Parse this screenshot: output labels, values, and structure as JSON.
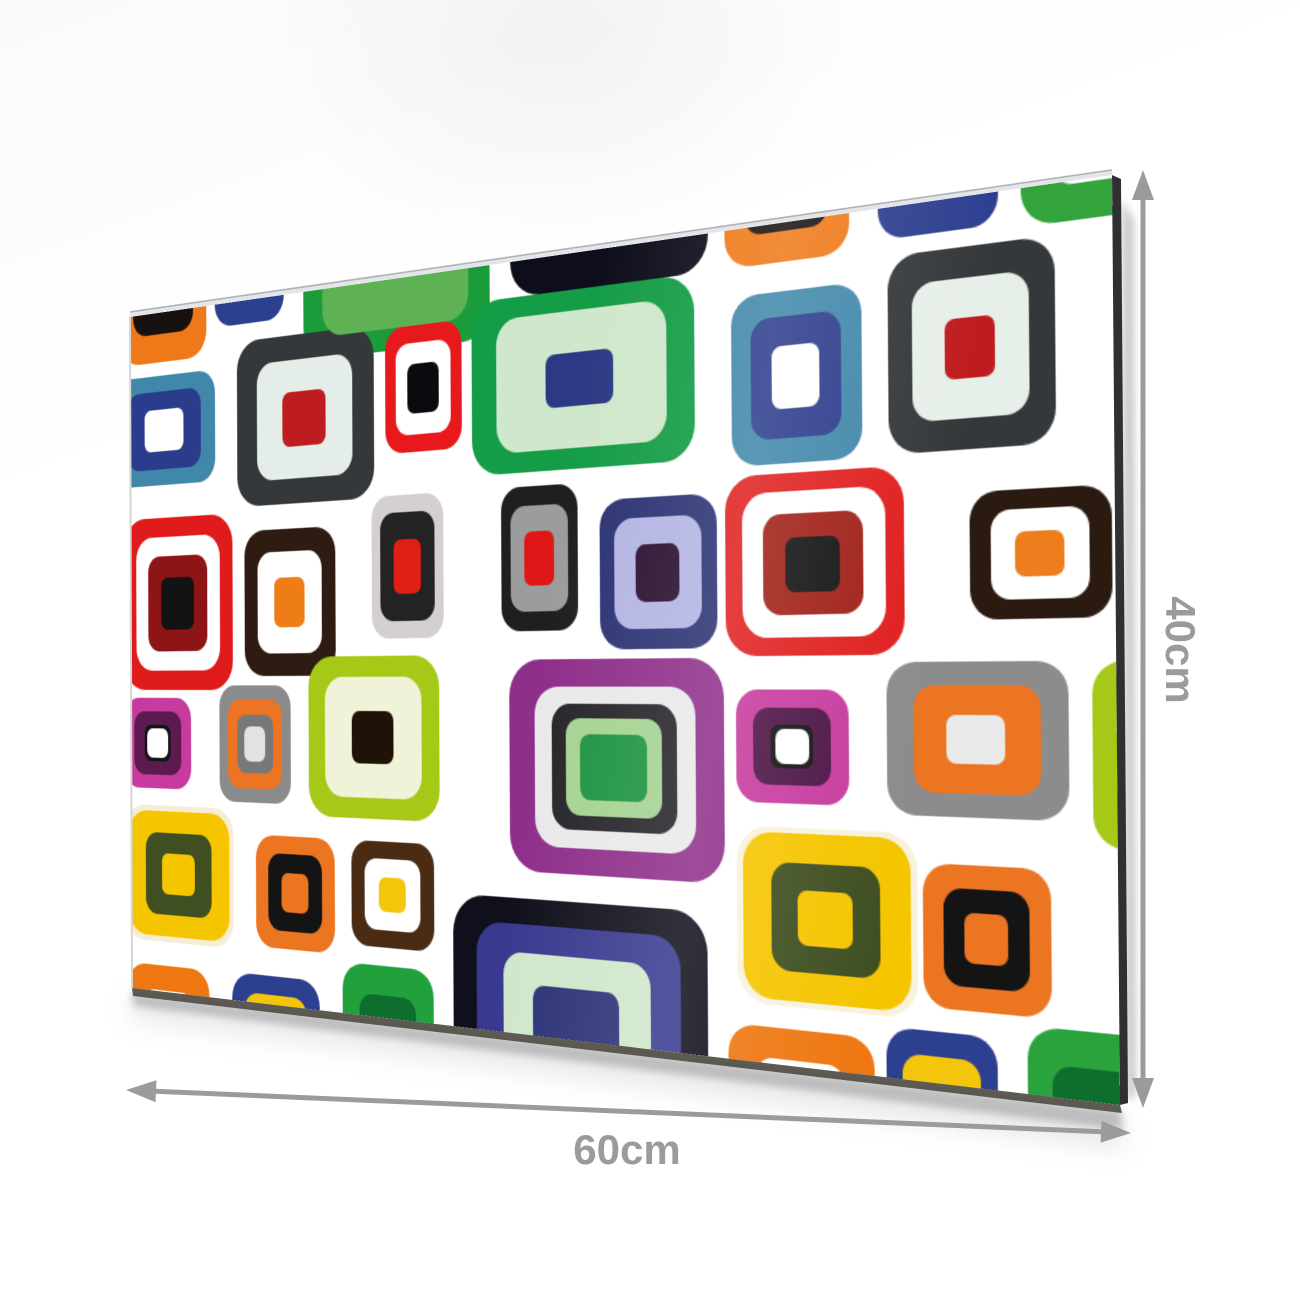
{
  "product": {
    "width_label": "60cm",
    "height_label": "40cm",
    "annotation_color": "#9b9b9b",
    "arrow": {
      "stroke_width": 5,
      "vertical": {
        "x": 1143,
        "y1": 170,
        "y2": 1108
      },
      "horizontal": {
        "x1": 126,
        "y1": 1090,
        "x2": 1131,
        "y2": 1133
      }
    },
    "labels": {
      "height_pos": {
        "x": 1180,
        "y": 650
      },
      "width_pos": {
        "x": 627,
        "y": 1126
      }
    },
    "panel": {
      "flat_width": 900,
      "flat_height": 600,
      "background": "#ffffff",
      "corners": {
        "tl": [
          130,
          317
        ],
        "tr": [
          1112,
          175
        ],
        "bl": [
          132,
          988
        ],
        "br": [
          1120,
          1105
        ]
      },
      "edge_colors": {
        "top_highlight": "#e3e6e9",
        "top_line": "#aeb2b6",
        "right_side": "#303034",
        "bottom_side": "#4e4a42",
        "left_line": "#d5d5d5",
        "shadow": "#8a8a8a",
        "soft_shadow": "#aaaaaa"
      },
      "tiles": [
        {
          "x": -12,
          "y": -120,
          "w": 106,
          "h": 164,
          "r": 26,
          "layers": [
            "#ef7918",
            "#17120f",
            "#ffffff"
          ],
          "scales": [
            1,
            0.7,
            0.42
          ]
        },
        {
          "x": 104,
          "y": -132,
          "w": 80,
          "h": 152,
          "r": 22,
          "layers": [
            "#2d3f8f",
            "#f3c50b",
            "#ffffff"
          ],
          "scales": [
            1,
            0.66,
            0.34
          ]
        },
        {
          "x": 206,
          "y": -104,
          "w": 194,
          "h": 162,
          "r": 30,
          "layers": [
            "#1b9c3b",
            "#5fb253"
          ],
          "scales": [
            1,
            0.78
          ]
        },
        {
          "x": 420,
          "y": -122,
          "w": 178,
          "h": 150,
          "r": 30,
          "layers": [
            "#0d0d1b"
          ],
          "scales": [
            1
          ]
        },
        {
          "x": 612,
          "y": -112,
          "w": 100,
          "h": 140,
          "r": 24,
          "layers": [
            "#ef7918",
            "#17120f",
            "#ffffff"
          ],
          "scales": [
            1,
            0.68,
            0.38
          ]
        },
        {
          "x": 734,
          "y": -116,
          "w": 88,
          "h": 138,
          "r": 22,
          "layers": [
            "#2d3f8f",
            "#f3c50b",
            "#ffffff"
          ],
          "scales": [
            1,
            0.66,
            0.34
          ]
        },
        {
          "x": 838,
          "y": -96,
          "w": 108,
          "h": 122,
          "r": 26,
          "layers": [
            "#33a43c",
            "#ffffff"
          ],
          "scales": [
            1,
            0.6
          ]
        },
        {
          "x": -20,
          "y": 56,
          "w": 124,
          "h": 97,
          "r": 22,
          "layers": [
            "#4187aa",
            "#2c3c8c",
            "#ffffff"
          ],
          "scales": [
            1,
            0.72,
            0.38
          ]
        },
        {
          "x": 130,
          "y": 35,
          "w": 152,
          "h": 142,
          "r": 28,
          "layers": [
            "#35383a",
            "#e4ede7",
            "#bf1c1f"
          ],
          "scales": [
            1,
            0.7,
            0.32
          ]
        },
        {
          "x": 294,
          "y": 40,
          "w": 78,
          "h": 102,
          "r": 20,
          "layers": [
            "#e8191c",
            "#ffffff",
            "#0a0a0f"
          ],
          "scales": [
            1,
            0.72,
            0.4
          ]
        },
        {
          "x": 382,
          "y": 28,
          "w": 204,
          "h": 137,
          "r": 30,
          "layers": [
            "#149c46",
            "#cfe7cb",
            "#2c3a85"
          ],
          "scales": [
            1,
            0.76,
            0.3
          ]
        },
        {
          "x": 617,
          "y": 49,
          "w": 104,
          "h": 123,
          "r": 24,
          "layers": [
            "#4187aa",
            "#2c3c8c",
            "#ffffff"
          ],
          "scales": [
            1,
            0.7,
            0.36
          ]
        },
        {
          "x": 741,
          "y": 34,
          "w": 120,
          "h": 137,
          "r": 26,
          "layers": [
            "#35383a",
            "#e7efe9",
            "#bf1c1f"
          ],
          "scales": [
            1,
            0.7,
            0.3
          ]
        },
        {
          "x": -8,
          "y": 182,
          "w": 132,
          "h": 152,
          "r": 28,
          "layers": [
            "#df1b1b",
            "#ffffff",
            "#8e1515",
            "#131313"
          ],
          "scales": [
            1,
            0.78,
            0.55,
            0.3
          ]
        },
        {
          "x": 138,
          "y": 198,
          "w": 102,
          "h": 124,
          "r": 24,
          "layers": [
            "#2e1c12",
            "#ffffff",
            "#ee7d18"
          ],
          "scales": [
            1,
            0.7,
            0.34
          ]
        },
        {
          "x": 279,
          "y": 176,
          "w": 74,
          "h": 116,
          "r": 20,
          "layers": [
            "#d5cfd3",
            "#232323",
            "#e02017"
          ],
          "scales": [
            1,
            0.76,
            0.38
          ]
        },
        {
          "x": 410,
          "y": 176,
          "w": 72,
          "h": 112,
          "r": 20,
          "layers": [
            "#1f1f1f",
            "#9c9c9c",
            "#e01717"
          ],
          "scales": [
            1,
            0.74,
            0.38
          ]
        },
        {
          "x": 502,
          "y": 190,
          "w": 102,
          "h": 113,
          "r": 24,
          "layers": [
            "#2b3272",
            "#b3b5e3",
            "#2a1030"
          ],
          "scales": [
            1,
            0.74,
            0.38
          ]
        },
        {
          "x": 611,
          "y": 179,
          "w": 141,
          "h": 130,
          "r": 28,
          "layers": [
            "#e01f1f",
            "#ffffff",
            "#a02018",
            "#141414"
          ],
          "scales": [
            1,
            0.8,
            0.56,
            0.3
          ]
        },
        {
          "x": 800,
          "y": 200,
          "w": 98,
          "h": 86,
          "r": 22,
          "layers": [
            "#2a1a10",
            "#ffffff",
            "#ee7d1d"
          ],
          "scales": [
            1,
            0.7,
            0.34
          ]
        },
        {
          "x": -8,
          "y": 341,
          "w": 82,
          "h": 80,
          "r": 20,
          "layers": [
            "#c73b9e",
            "#5c1a51",
            "#131313",
            "#ffffff"
          ],
          "scales": [
            1,
            0.7,
            0.4,
            0.32
          ]
        },
        {
          "x": 108,
          "y": 330,
          "w": 82,
          "h": 100,
          "r": 20,
          "layers": [
            "#8b8b8b",
            "#ec7422",
            "#787878",
            "#e2e2e2"
          ],
          "scales": [
            1,
            0.76,
            0.5,
            0.3
          ]
        },
        {
          "x": 210,
          "y": 306,
          "w": 138,
          "h": 133,
          "r": 28,
          "layers": [
            "#a5c916",
            "#f1f3d9",
            "#1f1207"
          ],
          "scales": [
            1,
            0.74,
            0.32
          ]
        },
        {
          "x": 417,
          "y": 310,
          "w": 192,
          "h": 164,
          "r": 32,
          "layers": [
            "#8e2f8a",
            "#e9e9ea",
            "#26262a",
            "#a6d392",
            "#1d9441"
          ],
          "scales": [
            1,
            0.75,
            0.58,
            0.45,
            0.31
          ]
        },
        {
          "x": 619,
          "y": 333,
          "w": 90,
          "h": 81,
          "r": 20,
          "layers": [
            "#c73b9e",
            "#4d1445",
            "#131313",
            "#ffffff"
          ],
          "scales": [
            1,
            0.68,
            0.38,
            0.3
          ]
        },
        {
          "x": 738,
          "y": 314,
          "w": 130,
          "h": 105,
          "r": 24,
          "layers": [
            "#8c8c8c",
            "#ec7522",
            "#e9e9e9"
          ],
          "scales": [
            1,
            0.7,
            0.32
          ]
        },
        {
          "x": 884,
          "y": 314,
          "w": 100,
          "h": 122,
          "r": 24,
          "layers": [
            "#a5c916",
            "#f1f3d9"
          ],
          "scales": [
            1,
            0.55
          ]
        },
        {
          "x": -8,
          "y": 436,
          "w": 132,
          "h": 120,
          "r": 26,
          "layers": [
            "#f6edd4",
            "#f5c500",
            "#3f4f21",
            "#f5c500"
          ],
          "scales": [
            1,
            0.92,
            0.6,
            0.3
          ]
        },
        {
          "x": 150,
          "y": 457,
          "w": 88,
          "h": 95,
          "r": 22,
          "layers": [
            "#ec7522",
            "#141414",
            "#ec7522"
          ],
          "scales": [
            1,
            0.68,
            0.34
          ]
        },
        {
          "x": 256,
          "y": 457,
          "w": 86,
          "h": 86,
          "r": 20,
          "layers": [
            "#4a2c14",
            "#ffffff",
            "#f3c50b"
          ],
          "scales": [
            1,
            0.68,
            0.32
          ]
        },
        {
          "x": 361,
          "y": 495,
          "w": 233,
          "h": 200,
          "r": 34,
          "layers": [
            "#10101c",
            "#39398f",
            "#cfe7cb",
            "#2c3177"
          ],
          "scales": [
            1,
            0.8,
            0.58,
            0.34
          ]
        },
        {
          "x": 619,
          "y": 431,
          "w": 141,
          "h": 127,
          "r": 28,
          "layers": [
            "#f8f2dc",
            "#f5c500",
            "#3f4f21",
            "#f5c500"
          ],
          "scales": [
            1,
            0.93,
            0.6,
            0.3
          ]
        },
        {
          "x": 764,
          "y": 451,
          "w": 91,
          "h": 98,
          "r": 22,
          "layers": [
            "#ec7522",
            "#141414",
            "#ec7522"
          ],
          "scales": [
            1,
            0.68,
            0.34
          ]
        },
        {
          "x": -5,
          "y": 577,
          "w": 100,
          "h": 110,
          "r": 24,
          "layers": [
            "#ee7711",
            "#ffffff"
          ],
          "scales": [
            1,
            0.6
          ]
        },
        {
          "x": 122,
          "y": 576,
          "w": 99,
          "h": 115,
          "r": 24,
          "layers": [
            "#2d3f8f",
            "#f3c50b",
            "#2d3f8f"
          ],
          "scales": [
            1,
            0.72,
            0.4
          ]
        },
        {
          "x": 246,
          "y": 558,
          "w": 95,
          "h": 125,
          "r": 24,
          "layers": [
            "#22a03c",
            "#0e6e2e"
          ],
          "scales": [
            1,
            0.62
          ]
        },
        {
          "x": 611,
          "y": 574,
          "w": 116,
          "h": 110,
          "r": 24,
          "layers": [
            "#ee7711",
            "#ffffff"
          ],
          "scales": [
            1,
            0.6
          ]
        },
        {
          "x": 736,
          "y": 565,
          "w": 81,
          "h": 115,
          "r": 22,
          "layers": [
            "#2d3f8f",
            "#f3c50b",
            "#2d3f8f"
          ],
          "scales": [
            1,
            0.7,
            0.38
          ]
        },
        {
          "x": 838,
          "y": 555,
          "w": 90,
          "h": 125,
          "r": 24,
          "layers": [
            "#2aa33c",
            "#0e6e2e"
          ],
          "scales": [
            1,
            0.62
          ]
        }
      ]
    }
  }
}
